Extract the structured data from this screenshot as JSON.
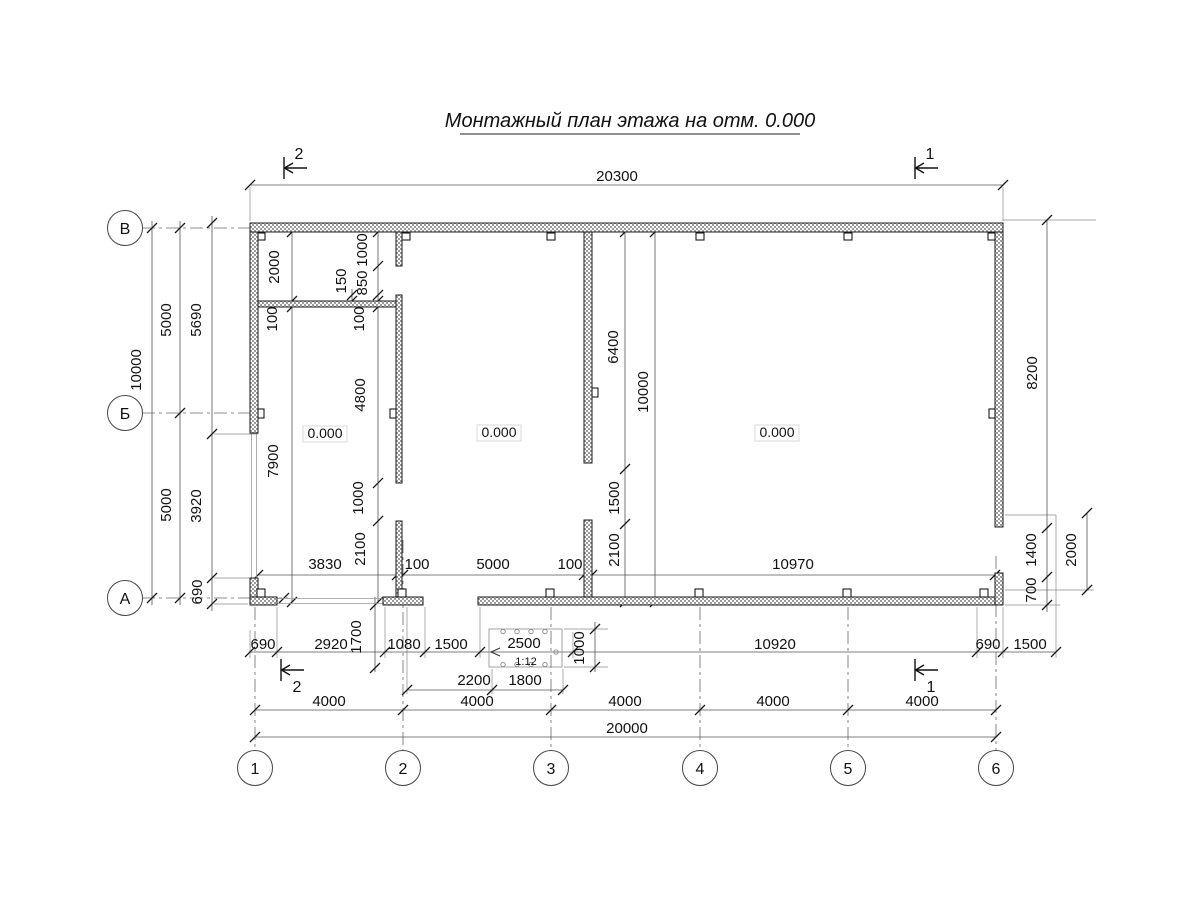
{
  "title": "Монтажный план этажа на отм. 0.000",
  "room_labels": [
    {
      "text": "0.000"
    },
    {
      "text": "0.000"
    },
    {
      "text": "0.000"
    }
  ],
  "axis_rows": [
    {
      "label": "В"
    },
    {
      "label": "Б"
    },
    {
      "label": "А"
    }
  ],
  "axis_cols": [
    {
      "label": "1"
    },
    {
      "label": "2"
    },
    {
      "label": "3"
    },
    {
      "label": "4"
    },
    {
      "label": "5"
    },
    {
      "label": "6"
    }
  ],
  "section_marks": {
    "top_left": "2",
    "top_right": "1",
    "bottom_left": "2",
    "bottom_right": "1"
  },
  "ramp": {
    "length": "2500",
    "slope": "1:12"
  },
  "dim_labels": [
    {
      "text": "20300",
      "x": 617,
      "y": 181,
      "rot": 0
    },
    {
      "text": "10000",
      "x": 141,
      "y": 370,
      "rot": -90
    },
    {
      "text": "5000",
      "x": 171,
      "y": 320,
      "rot": -90
    },
    {
      "text": "5000",
      "x": 171,
      "y": 505,
      "rot": -90
    },
    {
      "text": "5690",
      "x": 201,
      "y": 320,
      "rot": -90
    },
    {
      "text": "3920",
      "x": 201,
      "y": 506,
      "rot": -90
    },
    {
      "text": "690",
      "x": 202,
      "y": 592,
      "rot": -90
    },
    {
      "text": "2000",
      "x": 279,
      "y": 267,
      "rot": -90
    },
    {
      "text": "100",
      "x": 277,
      "y": 319,
      "rot": -90
    },
    {
      "text": "7900",
      "x": 278,
      "y": 461,
      "rot": -90
    },
    {
      "text": "1000",
      "x": 367,
      "y": 250,
      "rot": -90
    },
    {
      "text": "850",
      "x": 367,
      "y": 283,
      "rot": -90
    },
    {
      "text": "150",
      "x": 346,
      "y": 281,
      "rot": -90
    },
    {
      "text": "100",
      "x": 364,
      "y": 319,
      "rot": -90
    },
    {
      "text": "4800",
      "x": 365,
      "y": 395,
      "rot": -90
    },
    {
      "text": "1000",
      "x": 363,
      "y": 498,
      "rot": -90
    },
    {
      "text": "2100",
      "x": 365,
      "y": 549,
      "rot": -90
    },
    {
      "text": "6400",
      "x": 618,
      "y": 347,
      "rot": -90
    },
    {
      "text": "1500",
      "x": 619,
      "y": 498,
      "rot": -90
    },
    {
      "text": "2100",
      "x": 619,
      "y": 550,
      "rot": -90
    },
    {
      "text": "10000",
      "x": 648,
      "y": 392,
      "rot": -90
    },
    {
      "text": "8200",
      "x": 1037,
      "y": 373,
      "rot": -90
    },
    {
      "text": "1400",
      "x": 1036,
      "y": 550,
      "rot": -90
    },
    {
      "text": "700",
      "x": 1036,
      "y": 590,
      "rot": -90
    },
    {
      "text": "2000",
      "x": 1076,
      "y": 550,
      "rot": -90
    },
    {
      "text": "3830",
      "x": 325,
      "y": 569,
      "rot": 0
    },
    {
      "text": "100",
      "x": 417,
      "y": 569,
      "rot": 0
    },
    {
      "text": "5000",
      "x": 493,
      "y": 569,
      "rot": 0
    },
    {
      "text": "100",
      "x": 570,
      "y": 569,
      "rot": 0
    },
    {
      "text": "10970",
      "x": 793,
      "y": 569,
      "rot": 0
    },
    {
      "text": "690",
      "x": 263,
      "y": 649,
      "rot": 0
    },
    {
      "text": "2920",
      "x": 331,
      "y": 649,
      "rot": 0
    },
    {
      "text": "1700",
      "x": 361,
      "y": 637,
      "rot": -90
    },
    {
      "text": "1080",
      "x": 404,
      "y": 649,
      "rot": 0
    },
    {
      "text": "1500",
      "x": 451,
      "y": 649,
      "rot": 0
    },
    {
      "text": "2500",
      "x": 524,
      "y": 648,
      "rot": 0
    },
    {
      "text": "1:12",
      "x": 526,
      "y": 665,
      "rot": 0,
      "size": "small"
    },
    {
      "text": "1000",
      "x": 584,
      "y": 648,
      "rot": -90
    },
    {
      "text": "10920",
      "x": 775,
      "y": 649,
      "rot": 0
    },
    {
      "text": "690",
      "x": 988,
      "y": 649,
      "rot": 0
    },
    {
      "text": "1500",
      "x": 1030,
      "y": 649,
      "rot": 0
    },
    {
      "text": "2200",
      "x": 474,
      "y": 685,
      "rot": 0
    },
    {
      "text": "1800",
      "x": 525,
      "y": 685,
      "rot": 0
    },
    {
      "text": "4000",
      "x": 329,
      "y": 706,
      "rot": 0
    },
    {
      "text": "4000",
      "x": 477,
      "y": 706,
      "rot": 0
    },
    {
      "text": "4000",
      "x": 625,
      "y": 706,
      "rot": 0
    },
    {
      "text": "4000",
      "x": 773,
      "y": 706,
      "rot": 0
    },
    {
      "text": "4000",
      "x": 922,
      "y": 706,
      "rot": 0
    },
    {
      "text": "20000",
      "x": 627,
      "y": 733,
      "rot": 0
    }
  ]
}
